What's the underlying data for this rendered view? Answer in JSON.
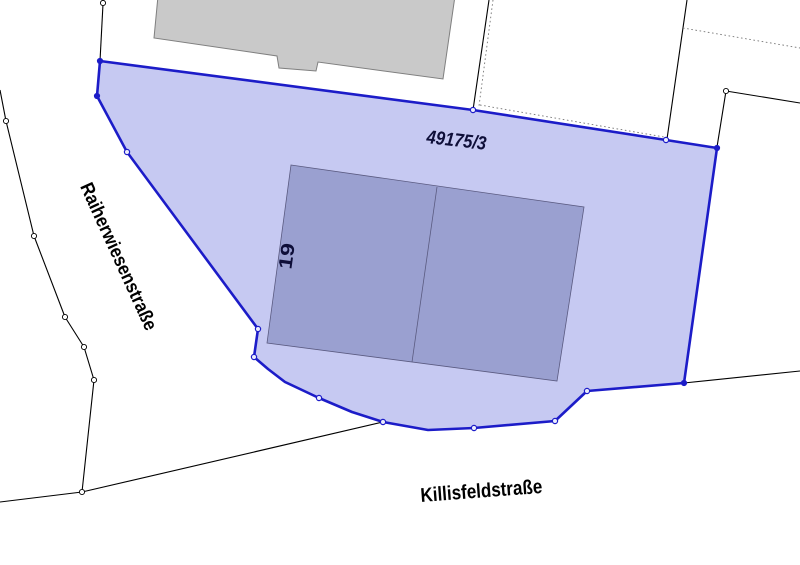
{
  "labels": {
    "parcel_number": "49175/3",
    "house_number": "19",
    "street_west": "Raiherwiesenstraße",
    "street_south": "Killisfeldstraße"
  },
  "colors": {
    "parcel_fill": "#c6c9f2",
    "parcel_stroke": "#1c1cc8",
    "building_fill": "#9aa0d0",
    "building_stroke": "#5a5a80",
    "neighbor_building_fill": "#c9c9c9",
    "neighbor_building_stroke": "#7f7f7f",
    "boundary_color": "#000000",
    "dotted_color": "#777777",
    "street_label_color": "#000000",
    "parcel_label_color": "#0e0e38"
  },
  "geometry": {
    "parcel": {
      "points": [
        [
          100,
          61
        ],
        [
          473,
          110
        ],
        [
          666,
          140
        ],
        [
          717,
          148
        ],
        [
          684,
          383
        ],
        [
          587,
          391
        ],
        [
          555,
          421
        ],
        [
          474,
          428
        ],
        [
          428,
          430
        ],
        [
          383,
          422
        ],
        [
          352,
          412
        ],
        [
          319,
          398
        ],
        [
          285,
          382
        ],
        [
          268,
          369
        ],
        [
          254,
          357
        ],
        [
          258,
          329
        ],
        [
          127,
          152
        ],
        [
          97,
          96
        ]
      ]
    },
    "building": {
      "points": [
        [
          291,
          165
        ],
        [
          584,
          207
        ],
        [
          557,
          381
        ],
        [
          267,
          343
        ]
      ],
      "divider": [
        [
          437,
          187
        ],
        [
          412,
          362
        ]
      ]
    },
    "neighbor_building": {
      "points": [
        [
          158,
          -4
        ],
        [
          154,
          38
        ],
        [
          277,
          56
        ],
        [
          279,
          68
        ],
        [
          316,
          71
        ],
        [
          318,
          62
        ],
        [
          443,
          79
        ],
        [
          455,
          -4
        ]
      ]
    },
    "boundary_lines": [
      [
        [
          103,
          4
        ],
        [
          100,
          61
        ]
      ],
      [
        [
          0,
          90
        ],
        [
          6,
          121
        ],
        [
          34,
          236
        ],
        [
          65,
          317
        ],
        [
          84,
          347
        ],
        [
          94,
          380
        ],
        [
          82,
          492
        ]
      ],
      [
        [
          0,
          502
        ],
        [
          82,
          492
        ],
        [
          383,
          422
        ]
      ],
      [
        [
          489,
          0
        ],
        [
          473,
          110
        ]
      ],
      [
        [
          687,
          0
        ],
        [
          667,
          139
        ]
      ],
      [
        [
          800,
          103
        ],
        [
          726,
          91
        ],
        [
          717,
          147
        ]
      ],
      [
        [
          684,
          383
        ],
        [
          800,
          371
        ]
      ]
    ],
    "dotted_lines": [
      [
        [
          493,
          0
        ],
        [
          479,
          106
        ]
      ],
      [
        [
          480,
          105
        ],
        [
          664,
          137
        ]
      ],
      [
        [
          683,
          28
        ],
        [
          800,
          48
        ]
      ]
    ],
    "open_markers": [
      [
        103,
        3
      ],
      [
        6,
        121
      ],
      [
        34,
        236
      ],
      [
        65,
        317
      ],
      [
        84,
        347
      ],
      [
        94,
        380
      ],
      [
        82,
        492
      ],
      [
        726,
        91
      ]
    ],
    "parcel_open_markers": [
      [
        127,
        152
      ],
      [
        258,
        329
      ],
      [
        254,
        357
      ],
      [
        319,
        398
      ],
      [
        383,
        422
      ],
      [
        474,
        428
      ],
      [
        555,
        421
      ],
      [
        587,
        391
      ],
      [
        473,
        110
      ],
      [
        666,
        140
      ]
    ],
    "parcel_filled_markers": [
      [
        100,
        61
      ],
      [
        97,
        96
      ],
      [
        717,
        148
      ],
      [
        684,
        383
      ]
    ]
  }
}
